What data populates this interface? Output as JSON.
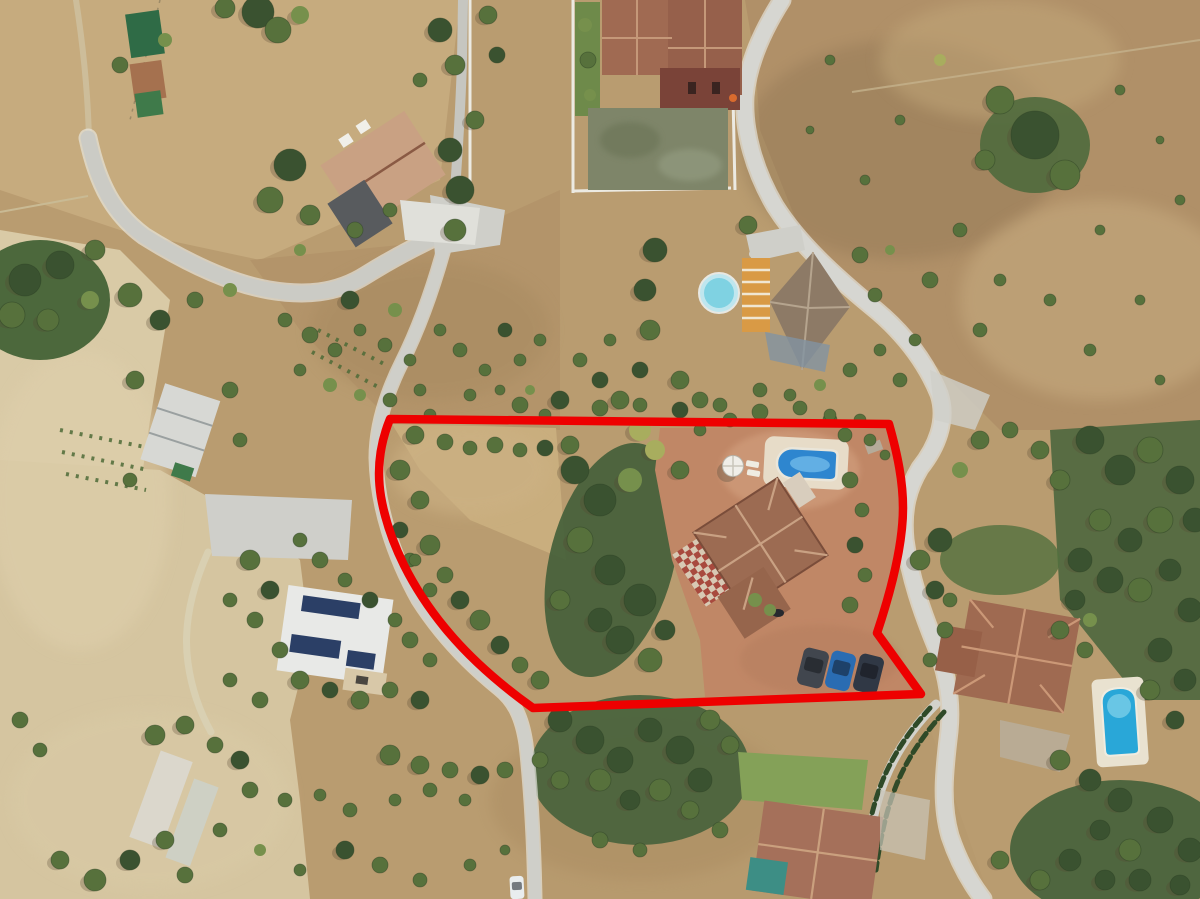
{
  "scene": {
    "description": "Aerial drone photograph of a rural Mediterranean hillside plot for sale, outlined with a thick red boundary. Inside the boundary: a villa with terracotta hip roof, rectangular swimming pool with roman end, white parasol, sun loungers, terracotta paved terrace, three parked cars and dry scrubland with trees. Surroundings: winding light-grey lanes, dry tan fields, orchards, a large villa with walled sports court at top, neighbouring houses with pools, a barn, greenhouses and a house with rooftop solar panels.",
    "no_visible_text": true
  },
  "colors": {
    "ground_base": "#b99c70",
    "ground_pale": "#d8c9a6",
    "ground_dirt": "#a98b60",
    "road": "#cfcfc9",
    "road_light": "#d6d6d1",
    "wall": "#eceae2",
    "lawn": "#7da055",
    "court": "#7e8569",
    "roof_terracotta": "#9c6b52",
    "roof_pale": "#c9a183",
    "villa_wall": "#7a4338",
    "solar_roof": "#e8e9e7",
    "solar_panel": "#2b3f66",
    "teal_roof": "#3d8e85",
    "pergola_orange": "#d99a45",
    "deck_white": "#e7dcc8"
  },
  "boundary": {
    "label": "property-boundary",
    "color": "#ee0000",
    "stroke_width": 8.5,
    "path": "M 390,419 L 889,424 C 898,456 903,482 903,508 C 903,543 892,588 877,633 L 921,694 L 533,708 C 505,688 472,661 445,628 C 413,589 389,543 381,497 C 376,467 381,441 390,419 Z"
  },
  "pools": {
    "subject_pool": "#2e86cf",
    "subject_pool_light": "#6fb9e8",
    "round_pool": "#7fd2e2",
    "round_pool_rim": "#bfe6ee",
    "southeast_pool": "#29a7d8",
    "southeast_pool_light": "#7fd0ea"
  },
  "objects": {
    "cars": [
      {
        "name": "car-dark-grey",
        "color": "#41464e"
      },
      {
        "name": "car-blue",
        "color": "#2a6cb2"
      },
      {
        "name": "car-dark-navy",
        "color": "#303845"
      },
      {
        "name": "car-white-on-lane",
        "color": "#e9edee"
      }
    ],
    "parasol": {
      "color": "#f0eee8"
    },
    "features": [
      "swimming-pool",
      "parasol",
      "sun-loungers",
      "paved-terrace",
      "parked-cars",
      "palm-trees",
      "scrubland"
    ]
  },
  "vegetation": {
    "palette": [
      "#3a5230",
      "#57713c",
      "#76904c",
      "#a8ad5e"
    ],
    "shadow_color": "#554733",
    "trees": [
      [
        258,
        12,
        16,
        0
      ],
      [
        278,
        30,
        13,
        1
      ],
      [
        225,
        8,
        10,
        1
      ],
      [
        300,
        15,
        9,
        2
      ],
      [
        120,
        65,
        8,
        1
      ],
      [
        165,
        40,
        7,
        2
      ],
      [
        95,
        250,
        10,
        1
      ],
      [
        60,
        265,
        14,
        0
      ],
      [
        25,
        280,
        16,
        0
      ],
      [
        12,
        315,
        13,
        1
      ],
      [
        48,
        320,
        11,
        1
      ],
      [
        90,
        300,
        9,
        2
      ],
      [
        130,
        295,
        12,
        1
      ],
      [
        160,
        320,
        10,
        0
      ],
      [
        195,
        300,
        8,
        1
      ],
      [
        230,
        290,
        7,
        2
      ],
      [
        355,
        230,
        8,
        1
      ],
      [
        390,
        210,
        7,
        1
      ],
      [
        300,
        250,
        6,
        2
      ],
      [
        290,
        165,
        16,
        0
      ],
      [
        270,
        200,
        13,
        1
      ],
      [
        310,
        215,
        10,
        1
      ],
      [
        450,
        150,
        12,
        0
      ],
      [
        460,
        190,
        14,
        0
      ],
      [
        455,
        230,
        11,
        1
      ],
      [
        475,
        120,
        9,
        1
      ],
      [
        440,
        30,
        12,
        0
      ],
      [
        455,
        65,
        10,
        1
      ],
      [
        488,
        15,
        9,
        1
      ],
      [
        497,
        55,
        8,
        0
      ],
      [
        420,
        80,
        7,
        1
      ],
      [
        585,
        25,
        7,
        2
      ],
      [
        588,
        60,
        8,
        1
      ],
      [
        590,
        95,
        6,
        2
      ],
      [
        748,
        225,
        9,
        1
      ],
      [
        1035,
        135,
        24,
        0
      ],
      [
        1000,
        100,
        14,
        1
      ],
      [
        1065,
        175,
        15,
        1
      ],
      [
        985,
        160,
        10,
        1
      ],
      [
        940,
        60,
        6,
        3
      ],
      [
        900,
        120,
        5,
        1
      ],
      [
        960,
        230,
        7,
        1
      ],
      [
        1000,
        280,
        6,
        1
      ],
      [
        930,
        280,
        8,
        1
      ],
      [
        890,
        250,
        5,
        2
      ],
      [
        1120,
        90,
        5,
        1
      ],
      [
        1160,
        140,
        4,
        1
      ],
      [
        1100,
        230,
        5,
        1
      ],
      [
        1050,
        300,
        6,
        1
      ],
      [
        980,
        330,
        7,
        1
      ],
      [
        830,
        60,
        5,
        1
      ],
      [
        810,
        130,
        4,
        1
      ],
      [
        865,
        180,
        5,
        1
      ],
      [
        1180,
        200,
        5,
        1
      ],
      [
        1140,
        300,
        5,
        1
      ],
      [
        1090,
        350,
        6,
        1
      ],
      [
        1160,
        380,
        5,
        1
      ],
      [
        285,
        320,
        7,
        1
      ],
      [
        310,
        335,
        8,
        1
      ],
      [
        335,
        350,
        7,
        1
      ],
      [
        300,
        370,
        6,
        1
      ],
      [
        330,
        385,
        7,
        2
      ],
      [
        360,
        330,
        6,
        1
      ],
      [
        385,
        345,
        7,
        1
      ],
      [
        410,
        360,
        6,
        1
      ],
      [
        360,
        395,
        6,
        2
      ],
      [
        390,
        400,
        7,
        1
      ],
      [
        420,
        390,
        6,
        1
      ],
      [
        430,
        415,
        6,
        1
      ],
      [
        350,
        300,
        9,
        0
      ],
      [
        395,
        310,
        7,
        2
      ],
      [
        440,
        330,
        6,
        1
      ],
      [
        460,
        350,
        7,
        1
      ],
      [
        485,
        370,
        6,
        1
      ],
      [
        470,
        395,
        6,
        1
      ],
      [
        500,
        390,
        5,
        1
      ],
      [
        520,
        360,
        6,
        1
      ],
      [
        505,
        330,
        7,
        0
      ],
      [
        540,
        340,
        6,
        1
      ],
      [
        530,
        390,
        5,
        2
      ],
      [
        545,
        415,
        6,
        1
      ],
      [
        135,
        380,
        9,
        1
      ],
      [
        230,
        390,
        8,
        1
      ],
      [
        240,
        440,
        7,
        1
      ],
      [
        130,
        480,
        7,
        1
      ],
      [
        655,
        250,
        12,
        0
      ],
      [
        645,
        290,
        11,
        0
      ],
      [
        650,
        330,
        10,
        1
      ],
      [
        860,
        255,
        8,
        1
      ],
      [
        875,
        295,
        7,
        1
      ],
      [
        680,
        380,
        9,
        1
      ],
      [
        700,
        400,
        8,
        1
      ],
      [
        640,
        370,
        8,
        0
      ],
      [
        620,
        400,
        9,
        1
      ],
      [
        600,
        380,
        8,
        0
      ],
      [
        580,
        360,
        7,
        1
      ],
      [
        610,
        340,
        6,
        1
      ],
      [
        760,
        390,
        7,
        1
      ],
      [
        790,
        395,
        6,
        1
      ],
      [
        820,
        385,
        6,
        2
      ],
      [
        850,
        370,
        7,
        1
      ],
      [
        880,
        350,
        6,
        1
      ],
      [
        730,
        420,
        7,
        1
      ],
      [
        700,
        430,
        6,
        1
      ],
      [
        830,
        420,
        7,
        1
      ],
      [
        860,
        420,
        6,
        1
      ],
      [
        520,
        405,
        8,
        1
      ],
      [
        560,
        400,
        9,
        0
      ],
      [
        600,
        408,
        8,
        1
      ],
      [
        640,
        405,
        7,
        1
      ],
      [
        680,
        410,
        8,
        0
      ],
      [
        720,
        405,
        7,
        1
      ],
      [
        760,
        412,
        8,
        1
      ],
      [
        800,
        408,
        7,
        1
      ],
      [
        830,
        415,
        6,
        1
      ],
      [
        415,
        435,
        9,
        1
      ],
      [
        445,
        442,
        8,
        1
      ],
      [
        470,
        448,
        7,
        1
      ],
      [
        495,
        445,
        8,
        1
      ],
      [
        520,
        450,
        7,
        1
      ],
      [
        545,
        448,
        8,
        0
      ],
      [
        570,
        445,
        9,
        1
      ],
      [
        400,
        470,
        10,
        1
      ],
      [
        420,
        500,
        9,
        1
      ],
      [
        400,
        530,
        8,
        0
      ],
      [
        430,
        545,
        10,
        1
      ],
      [
        410,
        560,
        7,
        1
      ],
      [
        445,
        575,
        8,
        1
      ],
      [
        460,
        600,
        9,
        0
      ],
      [
        480,
        620,
        10,
        1
      ],
      [
        500,
        645,
        9,
        0
      ],
      [
        520,
        665,
        8,
        1
      ],
      [
        540,
        680,
        9,
        1
      ],
      [
        575,
        470,
        14,
        0
      ],
      [
        600,
        500,
        16,
        0
      ],
      [
        580,
        540,
        13,
        1
      ],
      [
        610,
        570,
        15,
        0
      ],
      [
        640,
        600,
        16,
        0
      ],
      [
        620,
        640,
        14,
        0
      ],
      [
        650,
        660,
        12,
        1
      ],
      [
        600,
        620,
        12,
        0
      ],
      [
        665,
        630,
        10,
        0
      ],
      [
        560,
        600,
        10,
        1
      ],
      [
        630,
        480,
        12,
        2
      ],
      [
        655,
        450,
        10,
        3
      ],
      [
        680,
        470,
        9,
        1
      ],
      [
        640,
        430,
        11,
        3
      ],
      [
        850,
        480,
        8,
        1
      ],
      [
        862,
        510,
        7,
        1
      ],
      [
        855,
        545,
        8,
        0
      ],
      [
        865,
        575,
        7,
        1
      ],
      [
        850,
        605,
        8,
        1
      ],
      [
        770,
        610,
        6,
        2
      ],
      [
        755,
        600,
        7,
        2
      ],
      [
        845,
        435,
        7,
        1
      ],
      [
        870,
        440,
        6,
        1
      ],
      [
        885,
        455,
        5,
        1
      ],
      [
        560,
        720,
        12,
        0
      ],
      [
        590,
        740,
        14,
        0
      ],
      [
        620,
        760,
        13,
        0
      ],
      [
        650,
        730,
        12,
        0
      ],
      [
        680,
        750,
        14,
        0
      ],
      [
        700,
        780,
        12,
        0
      ],
      [
        660,
        790,
        11,
        1
      ],
      [
        630,
        800,
        10,
        0
      ],
      [
        600,
        780,
        11,
        1
      ],
      [
        710,
        720,
        10,
        1
      ],
      [
        730,
        745,
        9,
        1
      ],
      [
        690,
        810,
        9,
        1
      ],
      [
        720,
        830,
        8,
        1
      ],
      [
        600,
        840,
        8,
        1
      ],
      [
        640,
        850,
        7,
        1
      ],
      [
        560,
        780,
        9,
        1
      ],
      [
        540,
        760,
        8,
        1
      ],
      [
        390,
        755,
        10,
        1
      ],
      [
        420,
        765,
        9,
        1
      ],
      [
        450,
        770,
        8,
        1
      ],
      [
        480,
        775,
        9,
        0
      ],
      [
        505,
        770,
        8,
        1
      ],
      [
        250,
        790,
        8,
        1
      ],
      [
        285,
        800,
        7,
        1
      ],
      [
        320,
        795,
        6,
        1
      ],
      [
        350,
        810,
        7,
        1
      ],
      [
        395,
        800,
        6,
        1
      ],
      [
        430,
        790,
        7,
        1
      ],
      [
        465,
        800,
        6,
        1
      ],
      [
        345,
        850,
        9,
        0
      ],
      [
        380,
        865,
        8,
        1
      ],
      [
        300,
        870,
        6,
        1
      ],
      [
        420,
        880,
        7,
        1
      ],
      [
        470,
        865,
        6,
        1
      ],
      [
        505,
        850,
        5,
        1
      ],
      [
        260,
        850,
        6,
        2
      ],
      [
        220,
        830,
        7,
        1
      ],
      [
        155,
        735,
        10,
        1
      ],
      [
        185,
        725,
        9,
        1
      ],
      [
        215,
        745,
        8,
        1
      ],
      [
        240,
        760,
        9,
        0
      ],
      [
        165,
        840,
        9,
        1
      ],
      [
        130,
        860,
        10,
        0
      ],
      [
        95,
        880,
        11,
        1
      ],
      [
        60,
        860,
        9,
        1
      ],
      [
        185,
        875,
        8,
        1
      ],
      [
        20,
        720,
        8,
        1
      ],
      [
        40,
        750,
        7,
        1
      ],
      [
        250,
        560,
        10,
        1
      ],
      [
        270,
        590,
        9,
        0
      ],
      [
        255,
        620,
        8,
        1
      ],
      [
        230,
        600,
        7,
        1
      ],
      [
        280,
        650,
        8,
        1
      ],
      [
        300,
        680,
        9,
        1
      ],
      [
        330,
        690,
        8,
        0
      ],
      [
        360,
        700,
        9,
        1
      ],
      [
        390,
        690,
        8,
        1
      ],
      [
        420,
        700,
        9,
        0
      ],
      [
        260,
        700,
        8,
        1
      ],
      [
        230,
        680,
        7,
        1
      ],
      [
        410,
        640,
        8,
        1
      ],
      [
        430,
        660,
        7,
        1
      ],
      [
        395,
        620,
        7,
        1
      ],
      [
        370,
        600,
        8,
        0
      ],
      [
        345,
        580,
        7,
        1
      ],
      [
        320,
        560,
        8,
        1
      ],
      [
        300,
        540,
        7,
        1
      ],
      [
        415,
        560,
        6,
        1
      ],
      [
        430,
        590,
        7,
        1
      ],
      [
        1090,
        440,
        14,
        0
      ],
      [
        1120,
        470,
        15,
        0
      ],
      [
        1150,
        450,
        13,
        1
      ],
      [
        1180,
        480,
        14,
        0
      ],
      [
        1195,
        520,
        12,
        0
      ],
      [
        1160,
        520,
        13,
        1
      ],
      [
        1130,
        540,
        12,
        0
      ],
      [
        1100,
        520,
        11,
        1
      ],
      [
        1080,
        560,
        12,
        0
      ],
      [
        1110,
        580,
        13,
        0
      ],
      [
        1140,
        590,
        12,
        1
      ],
      [
        1170,
        570,
        11,
        0
      ],
      [
        1190,
        610,
        12,
        0
      ],
      [
        940,
        540,
        12,
        0
      ],
      [
        920,
        560,
        10,
        1
      ],
      [
        935,
        590,
        9,
        0
      ],
      [
        1060,
        480,
        10,
        1
      ],
      [
        1040,
        450,
        9,
        1
      ],
      [
        1010,
        430,
        8,
        1
      ],
      [
        980,
        440,
        9,
        1
      ],
      [
        960,
        470,
        8,
        2
      ],
      [
        1075,
        600,
        10,
        0
      ],
      [
        1060,
        630,
        9,
        1
      ],
      [
        1160,
        650,
        12,
        0
      ],
      [
        1185,
        680,
        11,
        0
      ],
      [
        1150,
        690,
        10,
        1
      ],
      [
        1175,
        720,
        9,
        0
      ],
      [
        1060,
        760,
        10,
        1
      ],
      [
        1090,
        780,
        11,
        0
      ],
      [
        1120,
        800,
        12,
        0
      ],
      [
        1160,
        820,
        13,
        0
      ],
      [
        1190,
        850,
        12,
        0
      ],
      [
        1130,
        850,
        11,
        1
      ],
      [
        1100,
        830,
        10,
        0
      ],
      [
        1070,
        860,
        11,
        0
      ],
      [
        1040,
        880,
        10,
        1
      ],
      [
        1000,
        860,
        9,
        1
      ],
      [
        1105,
        880,
        10,
        0
      ],
      [
        1140,
        880,
        11,
        0
      ],
      [
        1180,
        885,
        10,
        0
      ],
      [
        945,
        630,
        8,
        1
      ],
      [
        930,
        660,
        7,
        1
      ],
      [
        1085,
        650,
        8,
        1
      ],
      [
        1090,
        620,
        7,
        2
      ],
      [
        950,
        600,
        7,
        1
      ],
      [
        900,
        380,
        7,
        1
      ],
      [
        915,
        340,
        6,
        1
      ]
    ]
  }
}
